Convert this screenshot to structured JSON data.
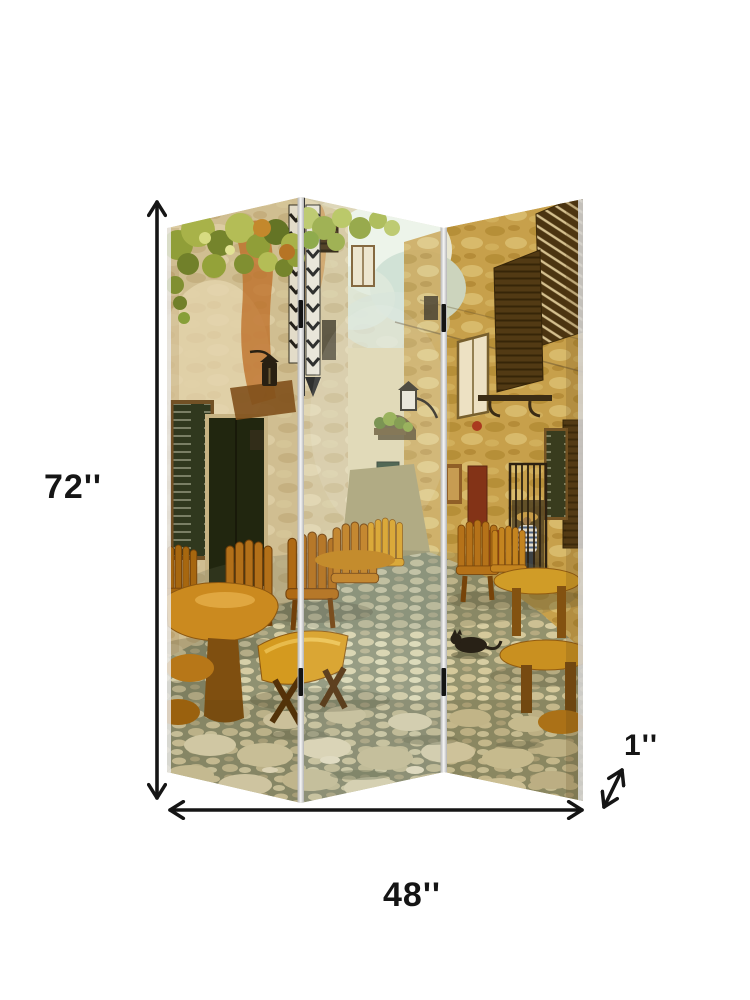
{
  "page": {
    "background_color": "#ffffff"
  },
  "product": {
    "name": "three-panel-folding-room-divider-screen",
    "panel_count": 3,
    "artwork_subject": "vintage old-town stone street with tavern tables, chairs, shuttered windows, menu blackboards and a black cat"
  },
  "dimensions": {
    "height_label": "72''",
    "width_label": "48''",
    "depth_label": "1''"
  },
  "icons": {
    "height_arrow": "vertical-double-arrow",
    "width_arrow": "horizontal-double-arrow",
    "depth_arrow": "diagonal-double-arrow"
  },
  "colors": {
    "page_background": "#ffffff",
    "dimension_line": "#151515",
    "label_text": "#151515",
    "fold_strip": "#c9c9c9",
    "hinge_black": "#141414",
    "stone_wall_warm": "#d4c59c",
    "stone_wall_light": "#ddd4b4",
    "stone_wall_gold": "#c9a452",
    "foliage_green": "#93a63c",
    "rust_streak": "#c0702a",
    "blackboard_green": "#27331f",
    "door_dark": "#16200f",
    "shutter_brown": "#443014",
    "wood_furniture": "#c8861e",
    "pavement_base": "#8e9479",
    "pavement_stone": "#e6e1c2",
    "sky_teal": "#cfe0d4",
    "sign_yellow": "#f0b818",
    "chair_red": "#9c3020",
    "cat_black": "#141416"
  }
}
